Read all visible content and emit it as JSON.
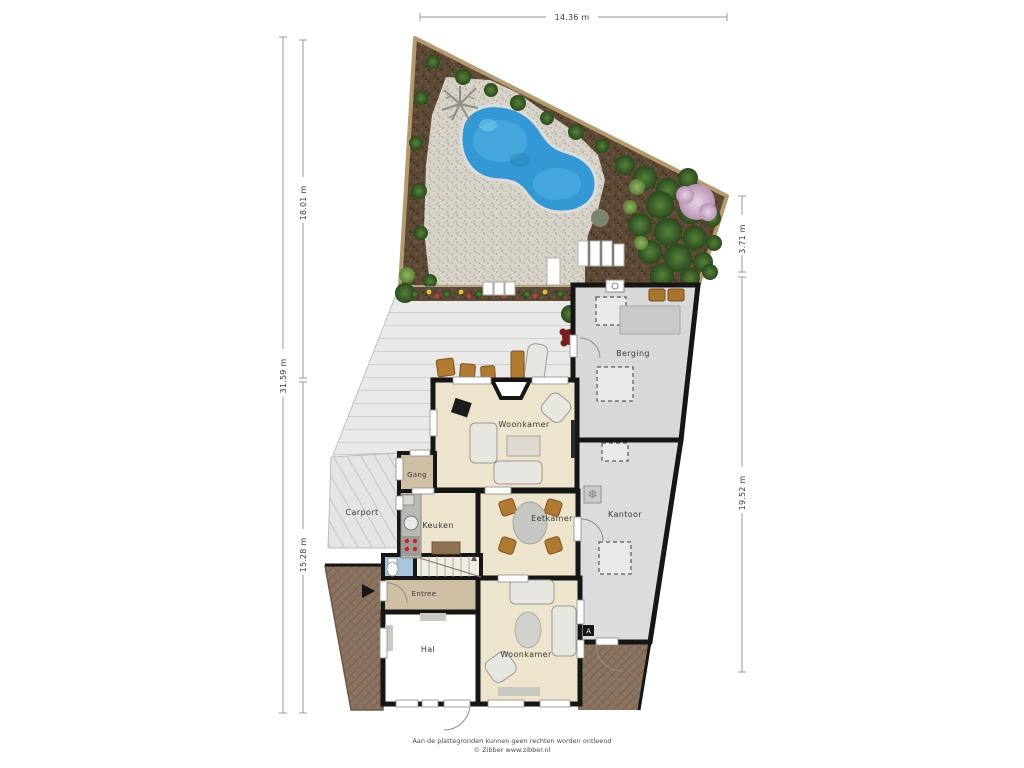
{
  "dimensions": {
    "top": "14.36 m",
    "left_outer": "31.59 m",
    "left_upper": "18.01 m",
    "left_lower": "15.28 m",
    "right_upper": "3.71 m",
    "right_lower": "19.52 m"
  },
  "rooms": {
    "berging": "Berging",
    "woonkamer_boven": "Woonkamer",
    "gang": "Gang",
    "carport": "Carport",
    "keuken": "Keuken",
    "eetkamer": "Eetkamer",
    "kantoor": "Kantoor",
    "entree": "Entree",
    "hal": "Hal",
    "woonkamer_beneden": "Woonkamer"
  },
  "markers": {
    "camera_label": "A"
  },
  "icons": {
    "ac_unit": "❆"
  },
  "footer": {
    "disclaimer": "Aan de plattegronden kunnen geen rechten worden ontleend",
    "copyright": "© Zibber www.zibber.nl"
  },
  "colors": {
    "wall": "#161616",
    "floor_beige": "#ece4cd",
    "floor_tan": "#cfc0a5",
    "floor_gray": "#d8d8d8",
    "floor_white": "#ffffff",
    "toilet_blue": "#a9c6de",
    "pool_blue": "#3498d4",
    "soil_brown": "#5c4936",
    "gravel": "#d7d3c9",
    "deck": "#e9e9e7",
    "tile_brown": "#8b7461",
    "bush_dark": "#2e4f22",
    "bush_light": "#6f9a4a",
    "tree_pink": "#cdb0cc"
  }
}
